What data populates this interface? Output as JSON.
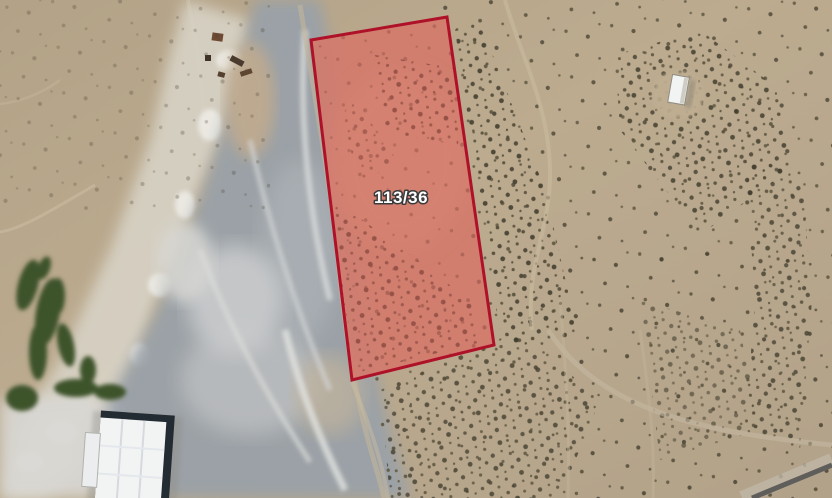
{
  "map": {
    "view_type": "satellite-imagery",
    "parcel": {
      "label": "113/36",
      "polygon_points": "311,40 447,17 494,345 352,380",
      "stroke_color": "#ae1128",
      "fill_color": "rgba(225,85,80,0.45)",
      "label_color": "#ffffff",
      "label_outline_color": "#3a3a3a"
    },
    "palette": {
      "sand": "#b8a88d",
      "quarry_gray": "#9aa1a8",
      "rock_light": "#d8d3c6",
      "vegetation_green": "#3d5329",
      "road_gray": "#5f5e5a",
      "building_roof_white": "#f2f4f4"
    }
  }
}
